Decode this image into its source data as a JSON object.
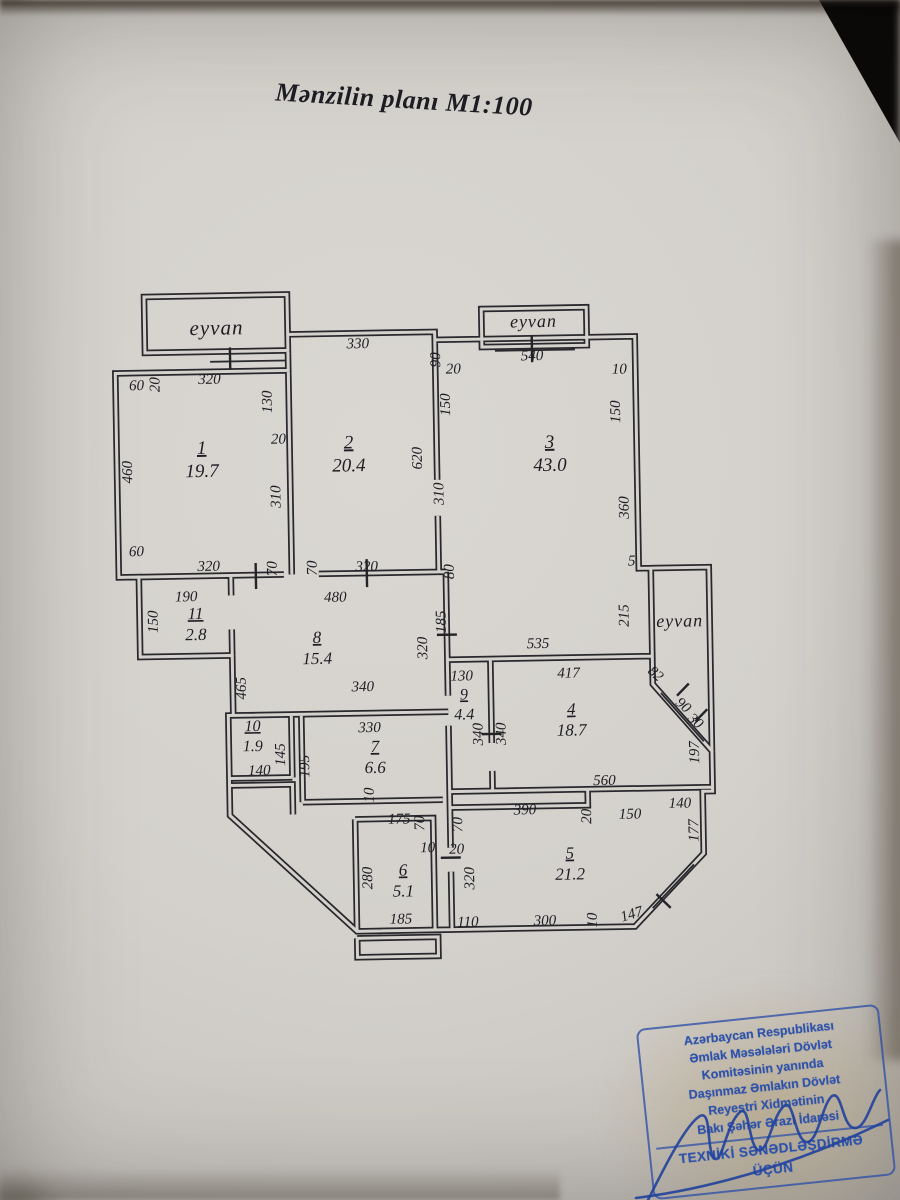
{
  "title": "Mənzilin planı M1:100",
  "plan": {
    "eyvans": [
      {
        "label": "eyvan",
        "x": 222,
        "y": 331,
        "s": 21
      },
      {
        "label": "eyvan",
        "x": 539,
        "y": 329,
        "s": 18
      },
      {
        "label": "eyvan",
        "x": 680,
        "y": 631,
        "s": 18
      }
    ],
    "rooms": [
      {
        "number": "1",
        "area": "19.7",
        "x": 205,
        "y": 450,
        "s": 19
      },
      {
        "number": "2",
        "area": "20.4",
        "x": 352,
        "y": 447,
        "s": 19
      },
      {
        "number": "3",
        "area": "43.0",
        "x": 553,
        "y": 450,
        "s": 19
      },
      {
        "number": "11",
        "area": "2.8",
        "x": 196,
        "y": 615,
        "s": 17
      },
      {
        "number": "8",
        "area": "15.4",
        "x": 317,
        "y": 641,
        "s": 17
      },
      {
        "number": "9",
        "area": "4.4",
        "x": 463,
        "y": 700,
        "s": 16
      },
      {
        "number": "4",
        "area": "18.7",
        "x": 570,
        "y": 717,
        "s": 17
      },
      {
        "number": "10",
        "area": "1.9",
        "x": 251,
        "y": 728,
        "s": 16
      },
      {
        "number": "7",
        "area": "6.6",
        "x": 373,
        "y": 751,
        "s": 17
      },
      {
        "number": "6",
        "area": "5.1",
        "x": 399,
        "y": 875,
        "s": 17
      },
      {
        "number": "5",
        "area": "21.2",
        "x": 566,
        "y": 861,
        "s": 17
      }
    ],
    "dims": [
      {
        "t": "60",
        "x": 141,
        "y": 385
      },
      {
        "t": "20",
        "x": 164,
        "y": 380,
        "r": -90
      },
      {
        "t": "320",
        "x": 214,
        "y": 380
      },
      {
        "t": "130",
        "x": 276,
        "y": 399,
        "r": -90
      },
      {
        "t": "20",
        "x": 282,
        "y": 441
      },
      {
        "t": "310",
        "x": 283,
        "y": 494,
        "r": -90
      },
      {
        "t": "460",
        "x": 135,
        "y": 467,
        "r": -90
      },
      {
        "t": "60",
        "x": 138,
        "y": 551
      },
      {
        "t": "320",
        "x": 210,
        "y": 567
      },
      {
        "t": "70",
        "x": 278,
        "y": 566,
        "r": -90
      },
      {
        "t": "330",
        "x": 363,
        "y": 347
      },
      {
        "t": "90",
        "x": 445,
        "y": 360,
        "r": -90
      },
      {
        "t": "20",
        "x": 458,
        "y": 374
      },
      {
        "t": "150",
        "x": 454,
        "y": 405,
        "r": -90
      },
      {
        "t": "620",
        "x": 425,
        "y": 458,
        "r": -90
      },
      {
        "t": "310",
        "x": 446,
        "y": 494,
        "r": -90
      },
      {
        "t": "70",
        "x": 318,
        "y": 566,
        "r": -90
      },
      {
        "t": "320",
        "x": 368,
        "y": 570
      },
      {
        "t": "80",
        "x": 455,
        "y": 572,
        "r": -90
      },
      {
        "t": "540",
        "x": 537,
        "y": 362
      },
      {
        "t": "10",
        "x": 624,
        "y": 377
      },
      {
        "t": "150",
        "x": 624,
        "y": 415,
        "r": -90
      },
      {
        "t": "360",
        "x": 631,
        "y": 511,
        "r": -90
      },
      {
        "t": "5",
        "x": 633,
        "y": 569
      },
      {
        "t": "535",
        "x": 538,
        "y": 650
      },
      {
        "t": "215",
        "x": 629,
        "y": 619,
        "r": -90
      },
      {
        "t": "190",
        "x": 187,
        "y": 597
      },
      {
        "t": "150",
        "x": 158,
        "y": 617,
        "r": -90
      },
      {
        "t": "480",
        "x": 336,
        "y": 600
      },
      {
        "t": "465",
        "x": 245,
        "y": 685,
        "r": -90
      },
      {
        "t": "340",
        "x": 362,
        "y": 690
      },
      {
        "t": "320",
        "x": 427,
        "y": 648,
        "r": -90
      },
      {
        "t": "185",
        "x": 446,
        "y": 622,
        "r": -90
      },
      {
        "t": "130",
        "x": 461,
        "y": 681
      },
      {
        "t": "340",
        "x": 481,
        "y": 735,
        "r": -90
      },
      {
        "t": "340",
        "x": 504,
        "y": 735,
        "r": -90
      },
      {
        "t": "417",
        "x": 568,
        "y": 680
      },
      {
        "t": "82",
        "x": 652,
        "y": 681,
        "r": 42
      },
      {
        "t": "90",
        "x": 679,
        "y": 713,
        "r": 42
      },
      {
        "t": "30",
        "x": 691,
        "y": 729,
        "r": 42
      },
      {
        "t": "197",
        "x": 697,
        "y": 757,
        "r": -90
      },
      {
        "t": "140",
        "x": 257,
        "y": 772
      },
      {
        "t": "145",
        "x": 283,
        "y": 752,
        "r": -90
      },
      {
        "t": "195",
        "x": 307,
        "y": 764,
        "r": -90
      },
      {
        "t": "330",
        "x": 368,
        "y": 731
      },
      {
        "t": "10",
        "x": 371,
        "y": 794,
        "r": -90
      },
      {
        "t": "175",
        "x": 396,
        "y": 823
      },
      {
        "t": "70",
        "x": 421,
        "y": 823,
        "r": -90
      },
      {
        "t": "70",
        "x": 459,
        "y": 825,
        "r": -90
      },
      {
        "t": "10",
        "x": 424,
        "y": 852
      },
      {
        "t": "20",
        "x": 453,
        "y": 854
      },
      {
        "t": "280",
        "x": 368,
        "y": 877,
        "r": -90
      },
      {
        "t": "185",
        "x": 396,
        "y": 923
      },
      {
        "t": "320",
        "x": 470,
        "y": 879,
        "r": -90
      },
      {
        "t": "110",
        "x": 463,
        "y": 927
      },
      {
        "t": "560",
        "x": 602,
        "y": 788
      },
      {
        "t": "390",
        "x": 522,
        "y": 816
      },
      {
        "t": "20",
        "x": 588,
        "y": 819,
        "r": -90
      },
      {
        "t": "150",
        "x": 627,
        "y": 822
      },
      {
        "t": "140",
        "x": 677,
        "y": 812
      },
      {
        "t": "177",
        "x": 695,
        "y": 835,
        "r": -90
      },
      {
        "t": "300",
        "x": 540,
        "y": 927
      },
      {
        "t": "10",
        "x": 592,
        "y": 923,
        "r": -90
      },
      {
        "t": "147",
        "x": 628,
        "y": 922,
        "r": -16
      }
    ]
  },
  "stamp": {
    "color": "#2e52aa",
    "lines": [
      "Azərbaycan Respublikası",
      "Əmlak Məsələləri Dövlət",
      "Komitəsinin yanında",
      "Daşınmaz Əmlakın Dövlət",
      "Reyestri Xidmətinin",
      "Bakı Şəhər Ərazi İdarəsi",
      "TEXNİKİ SƏNƏDLƏŞDİRMƏ",
      "ÜÇÜN"
    ]
  }
}
